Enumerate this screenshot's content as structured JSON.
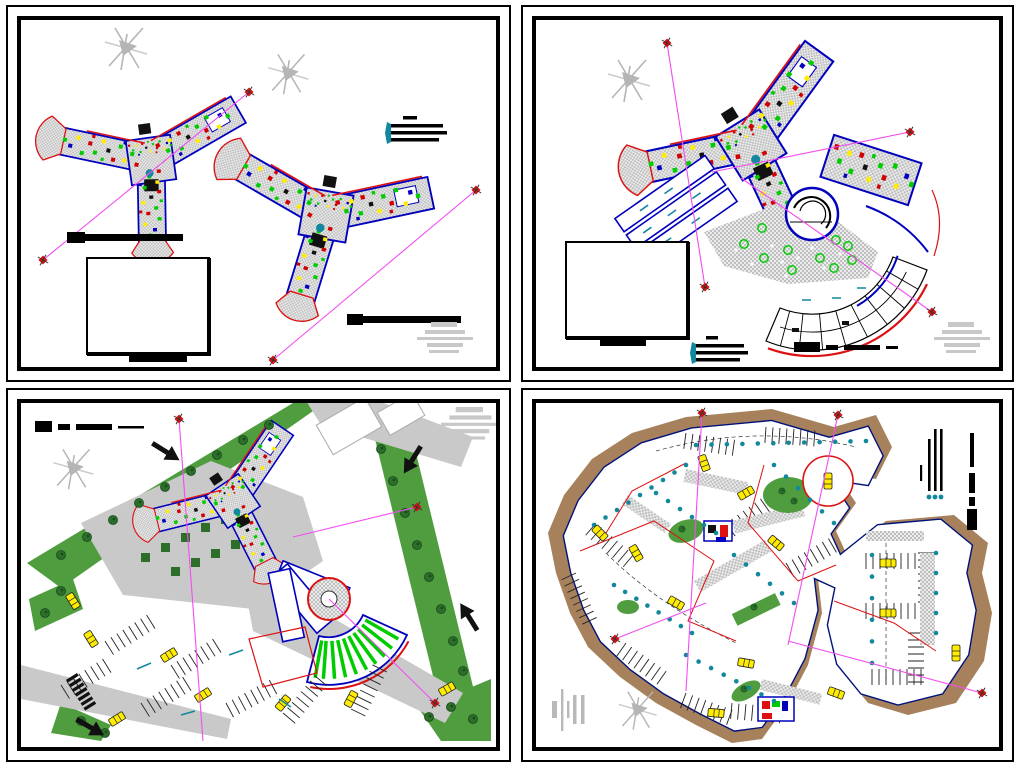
{
  "palette": {
    "paper_white": "#ffffff",
    "frame_black": "#000000",
    "wall_blue": "#0000bd",
    "accent_red": "#dd1111",
    "section_magenta": "#f14df1",
    "bright_green": "#00cc00",
    "landscape_green": "#4f9d3f",
    "tree_green": "#2c6e2a",
    "highlight_yellow": "#ffec00",
    "column_teal": "#12889e",
    "hatch_gray": "#c6c6c6",
    "road_gray": "#c9c9c9",
    "stamp_gray": "#c8c8c8",
    "north_gray": "#b5b5b5",
    "earth_brown": "#a6815c"
  },
  "sheets": [
    {
      "name": "floor-plan-sheet-two-plans",
      "plans": 2,
      "north_arrows": 2,
      "section_lines": 2,
      "scale_bars": 2,
      "title_block_empty": true,
      "approval_stamp": true
    },
    {
      "name": "floor-plan-sheet-fan-wing",
      "plans": 1,
      "north_arrows": 1,
      "section_lines": 3,
      "scale_bars": 1,
      "key_legend": true,
      "title_block_empty": true,
      "approval_stamp": true
    },
    {
      "name": "site-plan-sheet",
      "plans": 1,
      "north_arrows": 1,
      "section_lines": 3,
      "scale_bars": 1,
      "entrance_arrows": 4,
      "approval_stamp": true
    },
    {
      "name": "basement-parking-plan-sheet",
      "plans": 1,
      "north_arrows": 1,
      "section_lines": 4,
      "bar_legend": true,
      "gray_bar_stamp": true
    }
  ]
}
